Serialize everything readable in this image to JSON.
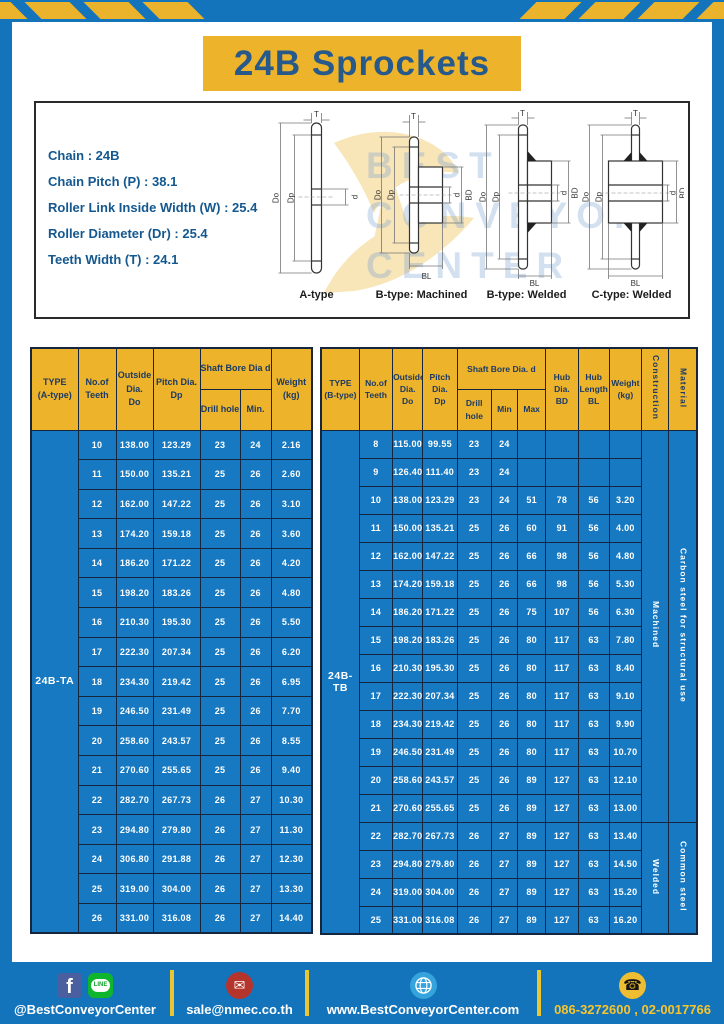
{
  "title": "24B Sprockets",
  "specs": {
    "lines": [
      "Chain : 24B",
      "Chain Pitch (P) : 38.1",
      "Roller Link Inside Width (W) : 25.4",
      "Roller Diameter (Dr) : 25.4",
      "Teeth Width (T) : 24.1"
    ]
  },
  "diagram": {
    "captions": [
      "A-type",
      "B-type: Machined",
      "B-type: Welded",
      "C-type: Welded"
    ],
    "dims": {
      "t": "T",
      "outside": "Do",
      "pitch": "Dp",
      "bore": "d",
      "hub_dia": "BD",
      "hub_len": "BL"
    },
    "watermark": [
      "BEST",
      "CONVEYOR",
      "CENTER"
    ]
  },
  "left_table": {
    "header": {
      "type": "TYPE\n(A-type)",
      "teeth": "No.of\nTeeth",
      "outside": "Outside\nDia.\nDo",
      "pitch": "Pitch Dia.\nDp",
      "shaft_bore": "Shaft Bore Dia d",
      "drill": "Drill hole",
      "min": "Min.",
      "weight": "Weight\n(kg)"
    },
    "type_label": "24B-TA",
    "rows": [
      [
        "10",
        "138.00",
        "123.29",
        "23",
        "24",
        "2.16"
      ],
      [
        "11",
        "150.00",
        "135.21",
        "25",
        "26",
        "2.60"
      ],
      [
        "12",
        "162.00",
        "147.22",
        "25",
        "26",
        "3.10"
      ],
      [
        "13",
        "174.20",
        "159.18",
        "25",
        "26",
        "3.60"
      ],
      [
        "14",
        "186.20",
        "171.22",
        "25",
        "26",
        "4.20"
      ],
      [
        "15",
        "198.20",
        "183.26",
        "25",
        "26",
        "4.80"
      ],
      [
        "16",
        "210.30",
        "195.30",
        "25",
        "26",
        "5.50"
      ],
      [
        "17",
        "222.30",
        "207.34",
        "25",
        "26",
        "6.20"
      ],
      [
        "18",
        "234.30",
        "219.42",
        "25",
        "26",
        "6.95"
      ],
      [
        "19",
        "246.50",
        "231.49",
        "25",
        "26",
        "7.70"
      ],
      [
        "20",
        "258.60",
        "243.57",
        "25",
        "26",
        "8.55"
      ],
      [
        "21",
        "270.60",
        "255.65",
        "25",
        "26",
        "9.40"
      ],
      [
        "22",
        "282.70",
        "267.73",
        "26",
        "27",
        "10.30"
      ],
      [
        "23",
        "294.80",
        "279.80",
        "26",
        "27",
        "11.30"
      ],
      [
        "24",
        "306.80",
        "291.88",
        "26",
        "27",
        "12.30"
      ],
      [
        "25",
        "319.00",
        "304.00",
        "26",
        "27",
        "13.30"
      ],
      [
        "26",
        "331.00",
        "316.08",
        "26",
        "27",
        "14.40"
      ]
    ]
  },
  "right_table": {
    "header": {
      "type": "TYPE\n(B-type)",
      "teeth": "No.of\nTeeth",
      "outside": "Outside\nDia.\nDo",
      "pitch": "Pitch\nDia.\nDp",
      "shaft_bore": "Shaft Bore Dia. d",
      "drill": "Drill hole",
      "min": "Min",
      "max": "Max",
      "hub_dia": "Hub\nDia.\nBD",
      "hub_len": "Hub\nLength\nBL",
      "weight": "Weight\n(kg)",
      "construction": "Construction",
      "material": "Material"
    },
    "type_label": "24B-TB",
    "rows": [
      [
        "8",
        "115.00",
        "99.55",
        "23",
        "24",
        "",
        "",
        "",
        ""
      ],
      [
        "9",
        "126.40",
        "111.40",
        "23",
        "24",
        "",
        "",
        "",
        ""
      ],
      [
        "10",
        "138.00",
        "123.29",
        "23",
        "24",
        "51",
        "78",
        "56",
        "3.20"
      ],
      [
        "11",
        "150.00",
        "135.21",
        "25",
        "26",
        "60",
        "91",
        "56",
        "4.00"
      ],
      [
        "12",
        "162.00",
        "147.22",
        "25",
        "26",
        "66",
        "98",
        "56",
        "4.80"
      ],
      [
        "13",
        "174.20",
        "159.18",
        "25",
        "26",
        "66",
        "98",
        "56",
        "5.30"
      ],
      [
        "14",
        "186.20",
        "171.22",
        "25",
        "26",
        "75",
        "107",
        "56",
        "6.30"
      ],
      [
        "15",
        "198.20",
        "183.26",
        "25",
        "26",
        "80",
        "117",
        "63",
        "7.80"
      ],
      [
        "16",
        "210.30",
        "195.30",
        "25",
        "26",
        "80",
        "117",
        "63",
        "8.40"
      ],
      [
        "17",
        "222.30",
        "207.34",
        "25",
        "26",
        "80",
        "117",
        "63",
        "9.10"
      ],
      [
        "18",
        "234.30",
        "219.42",
        "25",
        "26",
        "80",
        "117",
        "63",
        "9.90"
      ],
      [
        "19",
        "246.50",
        "231.49",
        "25",
        "26",
        "80",
        "117",
        "63",
        "10.70"
      ],
      [
        "20",
        "258.60",
        "243.57",
        "25",
        "26",
        "89",
        "127",
        "63",
        "12.10"
      ],
      [
        "21",
        "270.60",
        "255.65",
        "25",
        "26",
        "89",
        "127",
        "63",
        "13.00"
      ],
      [
        "22",
        "282.70",
        "267.73",
        "26",
        "27",
        "89",
        "127",
        "63",
        "13.40"
      ],
      [
        "23",
        "294.80",
        "279.80",
        "26",
        "27",
        "89",
        "127",
        "63",
        "14.50"
      ],
      [
        "24",
        "319.00",
        "304.00",
        "26",
        "27",
        "89",
        "127",
        "63",
        "15.20"
      ],
      [
        "25",
        "331.00",
        "316.08",
        "26",
        "27",
        "89",
        "127",
        "63",
        "16.20"
      ]
    ],
    "merges": [
      {
        "name": "construction",
        "segments": [
          {
            "label": "Machined",
            "span": 14
          },
          {
            "label": "Welded",
            "span": 4
          }
        ]
      },
      {
        "name": "material",
        "segments": [
          {
            "label": "Carbon steel for structural use",
            "span": 14
          },
          {
            "label": "Common steel",
            "span": 4
          }
        ]
      }
    ]
  },
  "footer": {
    "social_label": "@BestConveyorCenter",
    "email": "sale@nmec.co.th",
    "website": "www.BestConveyorCenter.com",
    "phones": "086-3272600 , 02-0017766",
    "icons": {
      "facebook": "f",
      "line": "LINE",
      "mail": "✉",
      "phone": "☎"
    }
  },
  "colors": {
    "blue": "#1474bb",
    "cell_blue": "#1779c2",
    "yellow": "#edb32b",
    "navy_text": "#1b3a63",
    "title_navy": "#27598a"
  }
}
